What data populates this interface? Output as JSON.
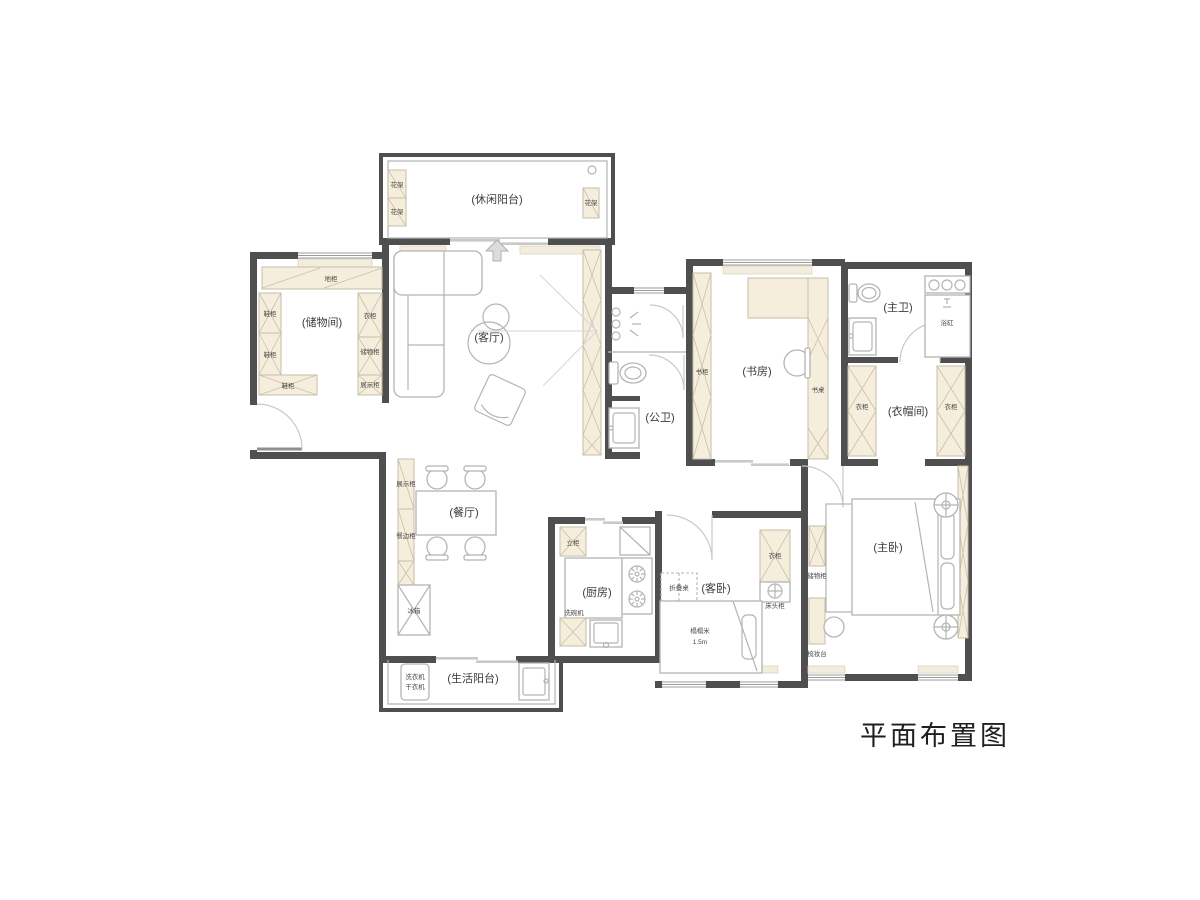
{
  "title": "平面布置图",
  "rooms": {
    "leisure_balcony": "(休闲阳台)",
    "storage_room": "(储物间)",
    "living_room": "(客厅)",
    "public_bathroom": "(公卫)",
    "study": "(书房)",
    "master_bathroom": "(主卫)",
    "cloakroom": "(衣帽间)",
    "master_bedroom": "(主卧)",
    "guest_bedroom": "(客卧)",
    "kitchen": "(厨房)",
    "dining_room": "(餐厅)",
    "service_balcony": "(生活阳台)"
  },
  "furniture": {
    "flower_rack": "花架",
    "base_cabinet": "地柜",
    "shoe_cabinet": "鞋柜",
    "wardrobe": "衣柜",
    "storage_cabinet": "储物柜",
    "display_cabinet": "展示柜",
    "bookshelf": "书柜",
    "desk": "书桌",
    "bathtub": "浴缸",
    "dresser": "梳妆台",
    "folding_table": "折叠桌",
    "nightstand": "床头柜",
    "tatami": "榻榻米",
    "tatami_size": "1.5m",
    "tall_cabinet": "立柜",
    "dishwasher": "洗碗机",
    "sideboard": "餐边柜",
    "fridge": "冰箱",
    "washer": "洗衣机",
    "dryer": "干衣机"
  },
  "colors": {
    "wall": "#4f4f4f",
    "cabinet_fill": "#f6eedc",
    "furniture_line": "#b4b4b4"
  }
}
